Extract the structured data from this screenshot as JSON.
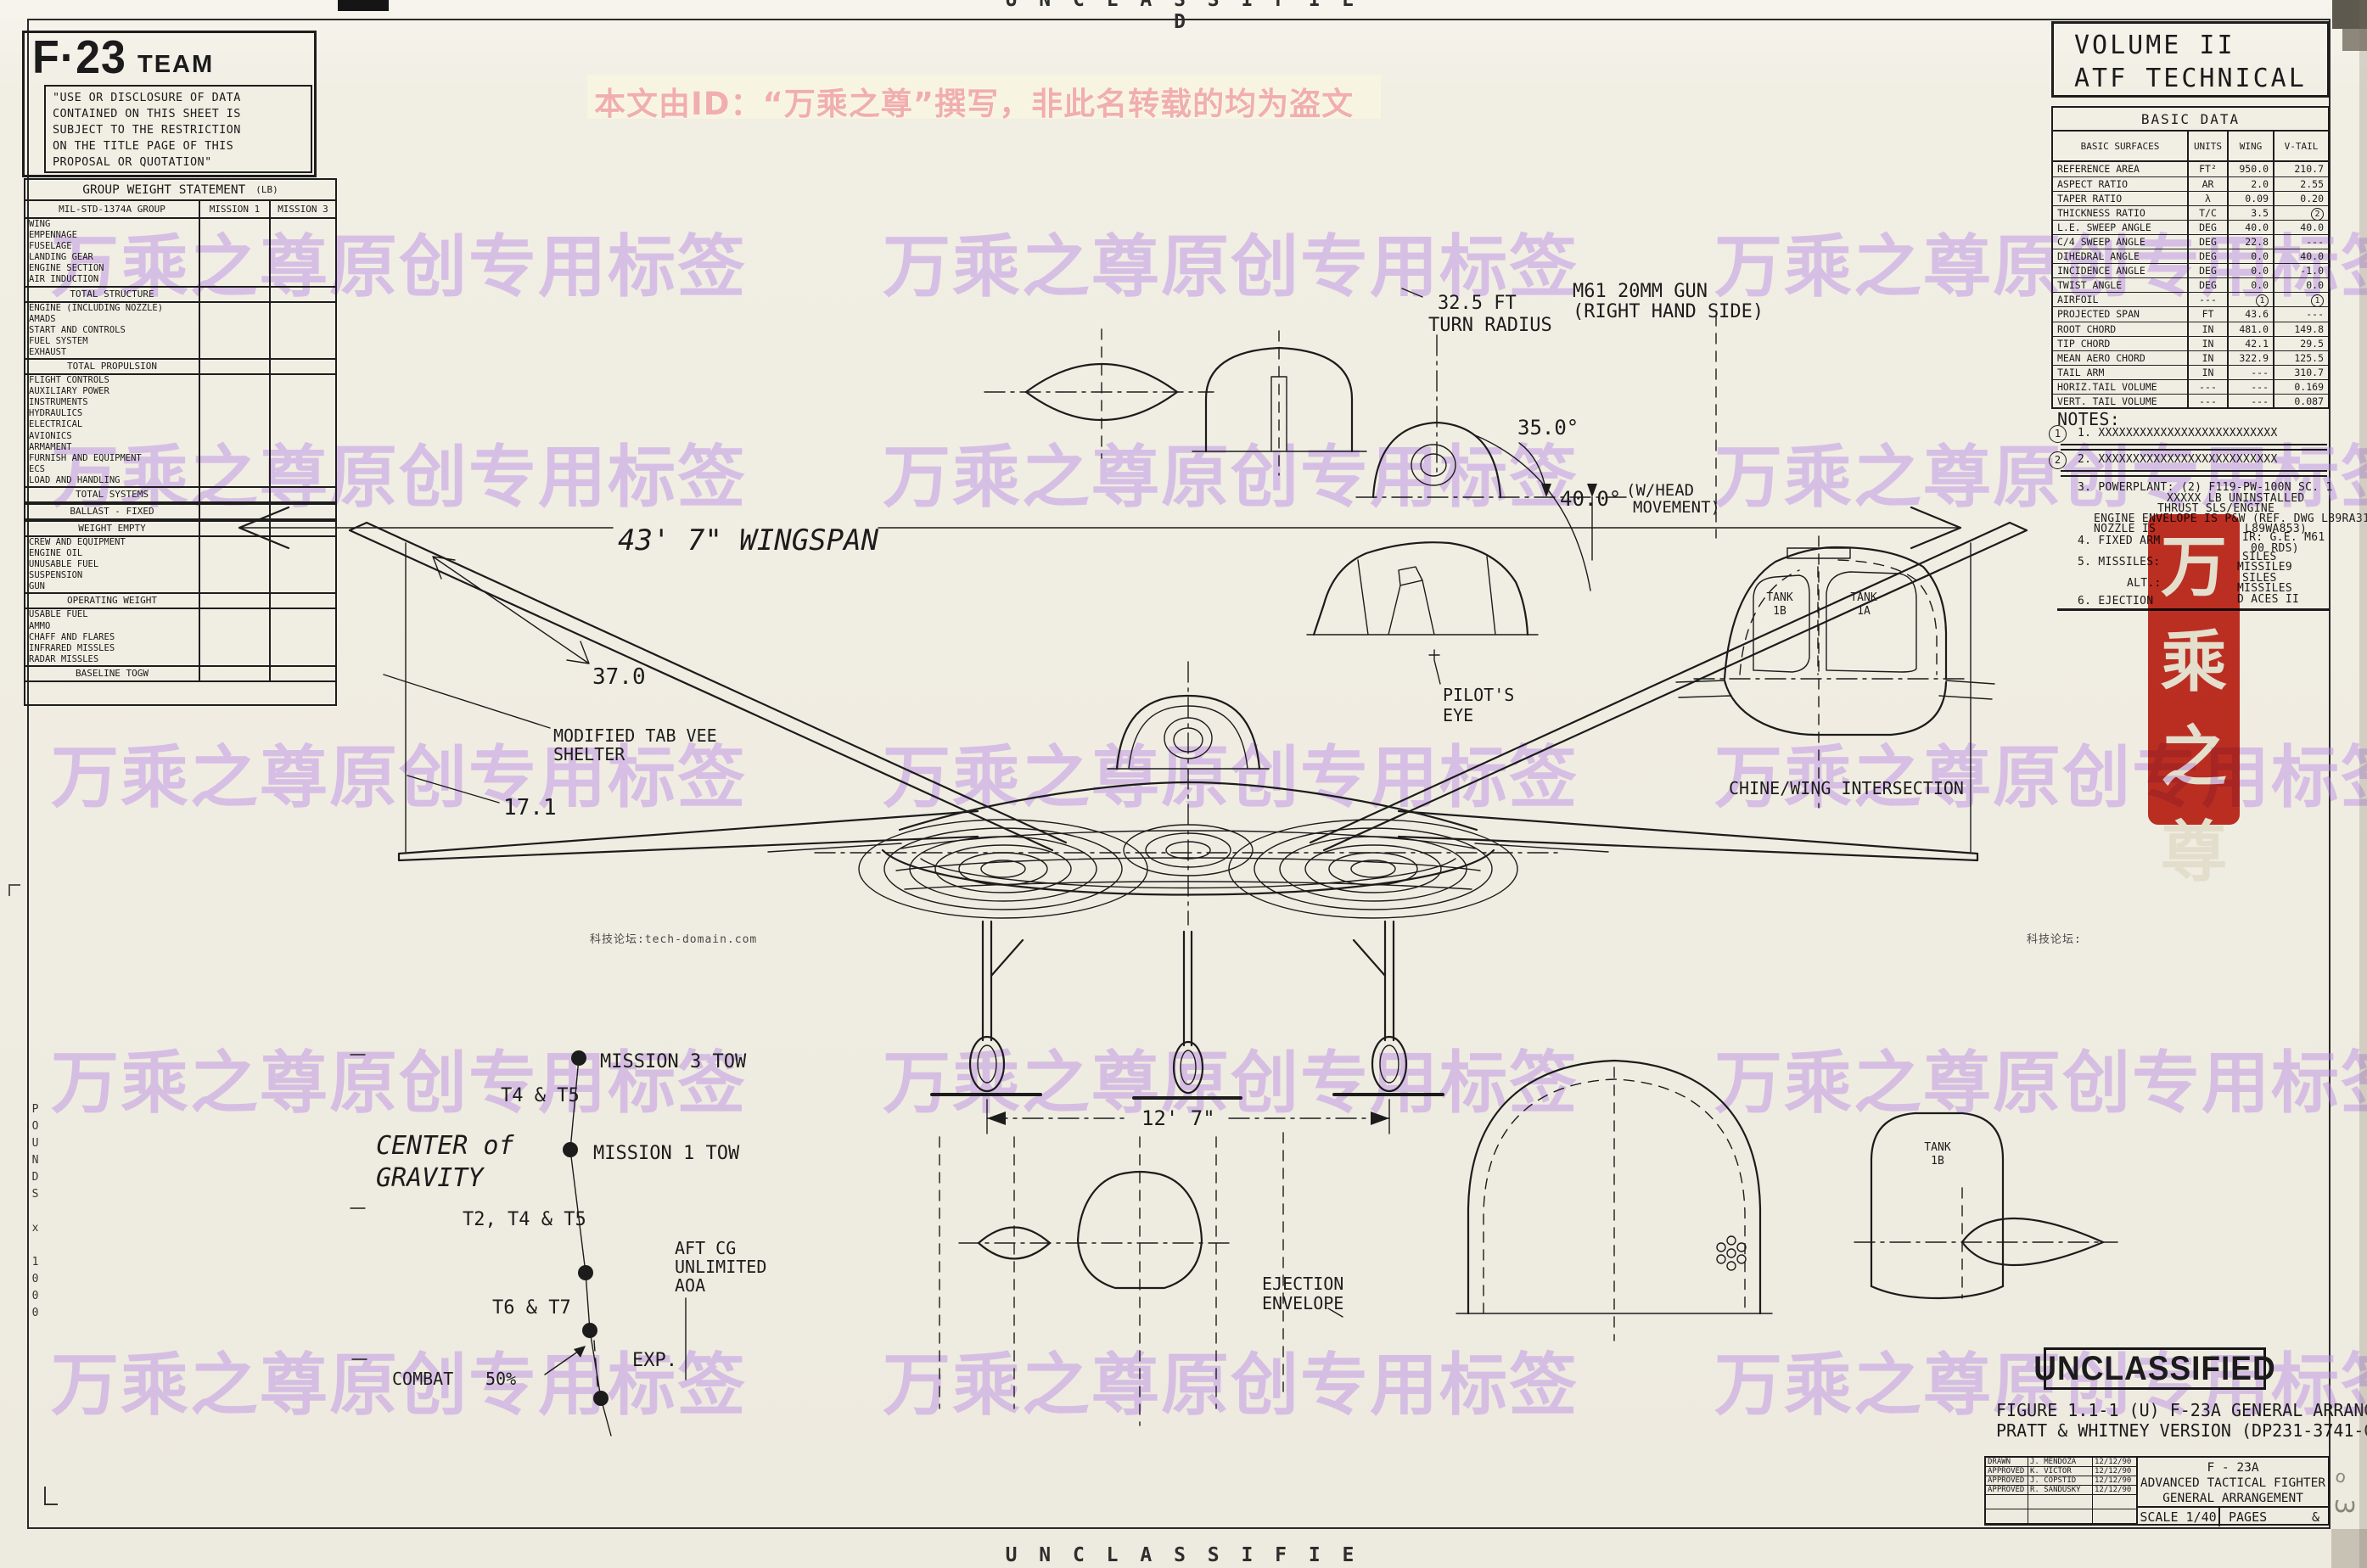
{
  "banners": {
    "top": "U N C L A S S I F I E D",
    "bottom": "U N C L A S S I F I E D"
  },
  "watermarks": {
    "tile_text": "万乘之尊原创专用标签",
    "notice_text": "本文由ID：“万乘之尊”撰写，非此名转载的均为盗文",
    "seal_chars": "万乘之尊",
    "forum_left": "科技论坛:tech-domain.com",
    "forum_right": "科技论坛:",
    "tile_color": "#bb8ce6",
    "seal_color": "#c4261a"
  },
  "team_panel": {
    "logo_main": "F·23",
    "logo_team": "TEAM",
    "disclosure_lines": [
      "\"USE OR DISCLOSURE OF DATA",
      "CONTAINED ON THIS SHEET IS",
      "SUBJECT TO THE RESTRICTION",
      "ON THE TITLE PAGE OF THIS",
      "PROPOSAL OR QUOTATION\""
    ]
  },
  "weight_table": {
    "title": "GROUP WEIGHT STATEMENT",
    "unit": "(LB)",
    "headers": [
      "MIL-STD-1374A GROUP",
      "MISSION 1",
      "MISSION 3"
    ],
    "rows": [
      {
        "t": "i",
        "label": "WING"
      },
      {
        "t": "i",
        "label": "EMPENNAGE"
      },
      {
        "t": "i",
        "label": "FUSELAGE"
      },
      {
        "t": "i",
        "label": "LANDING GEAR"
      },
      {
        "t": "i",
        "label": "ENGINE SECTION"
      },
      {
        "t": "i",
        "label": "AIR INDUCTION"
      },
      {
        "t": "s",
        "label": "TOTAL STRUCTURE"
      },
      {
        "t": "i",
        "label": "ENGINE (INCLUDING NOZZLE)"
      },
      {
        "t": "i",
        "label": "AMADS"
      },
      {
        "t": "i",
        "label": "START AND CONTROLS"
      },
      {
        "t": "i",
        "label": "FUEL SYSTEM"
      },
      {
        "t": "i",
        "label": "EXHAUST"
      },
      {
        "t": "s",
        "label": "TOTAL PROPULSION"
      },
      {
        "t": "i",
        "label": "FLIGHT CONTROLS"
      },
      {
        "t": "i",
        "label": "AUXILIARY POWER"
      },
      {
        "t": "i",
        "label": "INSTRUMENTS"
      },
      {
        "t": "i",
        "label": "HYDRAULICS"
      },
      {
        "t": "i",
        "label": "ELECTRICAL"
      },
      {
        "t": "i",
        "label": "AVIONICS"
      },
      {
        "t": "i",
        "label": "ARMAMENT"
      },
      {
        "t": "i",
        "label": "FURNISH AND EQUIPMENT"
      },
      {
        "t": "i",
        "label": "ECS"
      },
      {
        "t": "i",
        "label": "LOAD AND HANDLING"
      },
      {
        "t": "s",
        "label": "TOTAL SYSTEMS"
      },
      {
        "t": "s",
        "label": "BALLAST - FIXED"
      },
      {
        "t": "s",
        "label": "WEIGHT EMPTY"
      },
      {
        "t": "i",
        "label": "CREW AND EQUIPMENT"
      },
      {
        "t": "i",
        "label": "ENGINE OIL"
      },
      {
        "t": "i",
        "label": "UNUSABLE FUEL"
      },
      {
        "t": "i",
        "label": "SUSPENSION"
      },
      {
        "t": "i",
        "label": "GUN"
      },
      {
        "t": "s",
        "label": "OPERATING WEIGHT"
      },
      {
        "t": "i",
        "label": "USABLE FUEL"
      },
      {
        "t": "i",
        "label": "AMMO"
      },
      {
        "t": "i",
        "label": "CHAFF AND FLARES"
      },
      {
        "t": "i",
        "label": "INFRARED MISSLES"
      },
      {
        "t": "i",
        "label": "RADAR MISSLES"
      },
      {
        "t": "s",
        "label": "BASELINE TOGW"
      }
    ]
  },
  "volume_box": {
    "line1": "VOLUME II",
    "line2": "ATF TECHNICAL"
  },
  "basic_data": {
    "title": "BASIC DATA",
    "headers": [
      "BASIC SURFACES",
      "UNITS",
      "WING",
      "V-TAIL"
    ],
    "rows": [
      [
        "REFERENCE AREA",
        "FT²",
        "950.0",
        "210.7"
      ],
      [
        "ASPECT RATIO",
        "AR",
        "2.0",
        "2.55"
      ],
      [
        "TAPER RATIO",
        "λ",
        "0.09",
        "0.20"
      ],
      [
        "THICKNESS RATIO",
        "T/C",
        "3.5",
        "(2)"
      ],
      [
        "L.E. SWEEP ANGLE",
        "DEG",
        "40.0",
        "40.0"
      ],
      [
        "C/4 SWEEP ANGLE",
        "DEG",
        "22.8",
        "---"
      ],
      [
        "DIHEDRAL ANGLE",
        "DEG",
        "0.0",
        "40.0"
      ],
      [
        "INCIDENCE ANGLE",
        "DEG",
        "0.0",
        "-1.0"
      ],
      [
        "TWIST ANGLE",
        "DEG",
        "0.0",
        "0.0"
      ],
      [
        "AIRFOIL",
        "---",
        "(1)",
        "(1)"
      ],
      [
        "PROJECTED SPAN",
        "FT",
        "43.6",
        "---"
      ],
      [
        "ROOT CHORD",
        "IN",
        "481.0",
        "149.8"
      ],
      [
        "TIP CHORD",
        "IN",
        "42.1",
        "29.5"
      ],
      [
        "MEAN AERO CHORD",
        "IN",
        "322.9",
        "125.5"
      ],
      [
        "TAIL ARM",
        "IN",
        "---",
        "310.7"
      ],
      [
        "HORIZ.TAIL VOLUME",
        "---",
        "---",
        "0.169"
      ],
      [
        "VERT. TAIL VOLUME",
        "---",
        "---",
        "0.087"
      ]
    ]
  },
  "notes": {
    "heading": "NOTES:",
    "c1": "1",
    "c2": "2",
    "note1": "1. XXXXXXXXXXXXXXXXXXXXXXXXXX",
    "note2": "2. XXXXXXXXXXXXXXXXXXXXXXXXXX",
    "note3a": "3. POWERPLANT: (2) F119-PW-100N SC. 1",
    "note3b": "XXXXX LB UNINSTALLED",
    "note3c": "THRUST SLS/ENGINE",
    "note3d": "ENGINE ENVELOPE IS P&W (REF. DWG L89RA317)",
    "note3e": "NOZZLE IS",
    "note3e2": "L89WA853)",
    "note4a": "4. FIXED ARM",
    "note4b": "IR: G.E. M61",
    "note4c": "00 RDS)",
    "note5a": "5. MISSILES:",
    "note5b": "SILES",
    "note5c": "MISSILE9",
    "note5d": "ALT.:",
    "note5e": "SILES",
    "note5f": "MISSILES",
    "note6a": "6. EJECTION",
    "note6b": "D ACES II"
  },
  "drawing": {
    "wingspan": "43' 7\" WINGSPAN",
    "turn_radius_1": "32.5 FT",
    "turn_radius_2": "TURN RADIUS",
    "gun_1": "M61 20MM GUN",
    "gun_2": "(RIGHT HAND SIDE)",
    "angle_35": "35.0°",
    "angle_40": "40.0°",
    "head_move_1": "(W/HEAD",
    "head_move_2": "MOVEMENT)",
    "pilots_eye_1": "PILOT'S",
    "pilots_eye_2": "EYE",
    "tank_b": "TANK",
    "tank_b2": "1B",
    "tank_a": "TANK",
    "tank_a2": "1A",
    "chine": "CHINE/WING INTERSECTION",
    "tab_vee_1": "MODIFIED TAB VEE",
    "tab_vee_2": "SHELTER",
    "dim_37": "37.0",
    "dim_17": "17.1",
    "dim_12_7": "12' 7\"",
    "ejection_1": "EJECTION",
    "ejection_2": "ENVELOPE",
    "tank_1b_lower_1": "TANK",
    "tank_1b_lower_2": "1B"
  },
  "cg_chart": {
    "axis_label": "POUNDS x 1000",
    "title_1": "CENTER of",
    "title_2": "GRAVITY",
    "mission3": "MISSION 3 TOW",
    "t4t5": "T4 & T5",
    "mission1": "MISSION 1 TOW",
    "t2t4t5": "T2, T4 & T5",
    "t6t7": "T6 & T7",
    "aft_cg_1": "AFT CG",
    "aft_cg_2": "UNLIMITED",
    "aft_cg_3": "AOA",
    "exp": "EXP.",
    "combat": "COMBAT",
    "combat2": "50%"
  },
  "title_block": {
    "stamp": "UNCLASSIFIED",
    "caption_1": "FIGURE 1.1-1 (U) F-23A GENERAL ARRANGEMENT",
    "caption_2": "PRATT & WHITNEY VERSION (DP231-3741-GA)",
    "sign_rows": [
      [
        "DRAWN",
        "J. MENDOZA",
        "12/12/90"
      ],
      [
        "APPROVED",
        "K. VICTOR",
        "12/12/90"
      ],
      [
        "APPROVED",
        "J. COPSTID",
        "12/12/90"
      ],
      [
        "APPROVED",
        "R. SANDUSKY",
        "12/12/90"
      ]
    ],
    "title_1": "F - 23A",
    "title_2": "ADVANCED TACTICAL FIGHTER",
    "title_3": "GENERAL ARRANGEMENT",
    "scale": "SCALE 1/40",
    "pages": "PAGES",
    "pages_val": "&"
  }
}
